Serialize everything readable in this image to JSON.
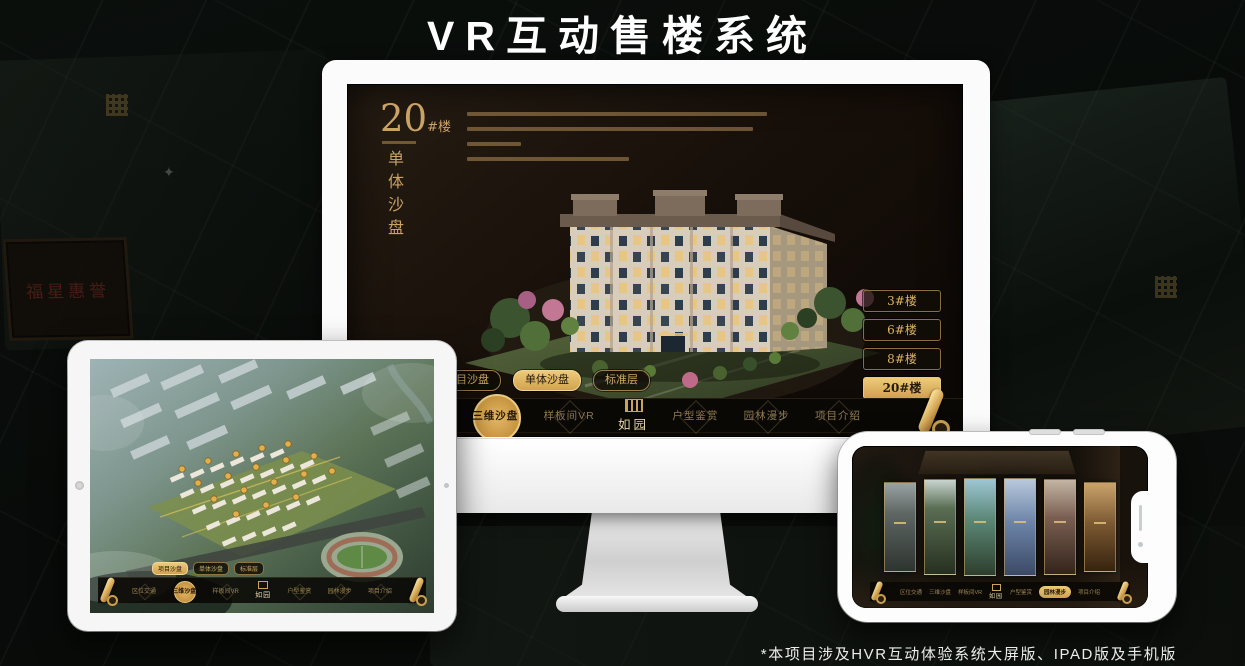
{
  "page": {
    "title": "VR互动售楼系统",
    "footnote": "*本项目涉及HVR互动体验系统大屏版、IPAD版及手机版"
  },
  "brand": {
    "logo_text": "如园",
    "gold": "#d8ae64",
    "gold_active_bg": "#e0b561",
    "screen_bg": "#170f09"
  },
  "background": {
    "plaque_text": "福星惠誉"
  },
  "desktop": {
    "block_no": "20",
    "block_suffix": "#楼",
    "section_title": "单体沙盘",
    "floor_buttons": [
      {
        "label": "3#楼",
        "active": false
      },
      {
        "label": "6#楼",
        "active": false
      },
      {
        "label": "8#楼",
        "active": false
      },
      {
        "label": "20#楼",
        "active": true
      }
    ],
    "tabs": [
      {
        "label": "项目沙盘",
        "active": false
      },
      {
        "label": "单体沙盘",
        "active": true
      },
      {
        "label": "标准层",
        "active": false
      }
    ],
    "nav": [
      {
        "label": "区位交通",
        "active": false
      },
      {
        "label": "三维沙盘",
        "active": true
      },
      {
        "label": "样板间VR",
        "active": false
      },
      {
        "label": "户型鉴赏",
        "active": false
      },
      {
        "label": "园林漫步",
        "active": false
      },
      {
        "label": "项目介绍",
        "active": false
      }
    ]
  },
  "tablet": {
    "tabs": [
      {
        "label": "项目沙盘",
        "active": true
      },
      {
        "label": "单体沙盘",
        "active": false
      },
      {
        "label": "标准层",
        "active": false
      }
    ],
    "nav": [
      {
        "label": "区位交通",
        "active": false
      },
      {
        "label": "三维沙盘",
        "active": true
      },
      {
        "label": "样板间VR",
        "active": false
      },
      {
        "label": "户型鉴赏",
        "active": false
      },
      {
        "label": "园林漫步",
        "active": false
      },
      {
        "label": "项目介绍",
        "active": false
      }
    ]
  },
  "phone": {
    "nav": [
      {
        "label": "区位交通",
        "active": false
      },
      {
        "label": "三维沙盘",
        "active": false
      },
      {
        "label": "样板间VR",
        "active": false
      },
      {
        "label": "户型鉴赏",
        "active": false
      },
      {
        "label": "园林漫步",
        "active": true
      },
      {
        "label": "项目介绍",
        "active": false
      }
    ]
  }
}
